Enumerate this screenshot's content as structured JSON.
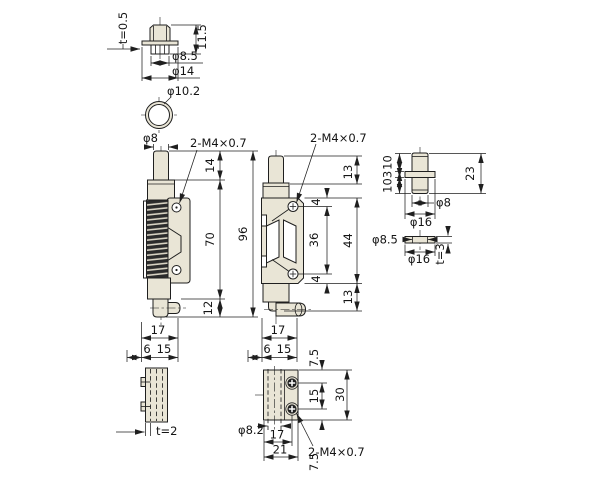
{
  "drawing_type": "engineering-dimension-drawing",
  "part": "spring-loaded latch bolt with mounting plate, pin, washer and cap",
  "colors": {
    "bg": "#ffffff",
    "line": "#1f1f1f",
    "metal": "#e9e5d6",
    "spring": "#2b2b2b",
    "spring_gap": "#d8d3c3"
  },
  "views": {
    "cap": {
      "thickness": "t=0.5",
      "height": "11.5",
      "inner_dia": "φ8.5",
      "flange_dia": "φ14"
    },
    "top": {
      "outer_dia": "φ10.2"
    },
    "front": {
      "pin_dia": "φ8",
      "thread": "2-M4×0.7",
      "pin_len": "14",
      "body_len": "70",
      "total_len": "96",
      "tail_len": "12",
      "width": "17",
      "offset": "6",
      "plate_w": "15"
    },
    "side": {
      "thread": "2-M4×0.7",
      "top_gap": "13",
      "hole_edge_top": "4",
      "hole_pitch": "36",
      "plate_len": "44",
      "hole_edge_bottom": "4",
      "bottom_gap": "13",
      "width": "17",
      "offset": "6",
      "plate_w": "15"
    },
    "pin": {
      "top_len": "10",
      "flange_t": "3",
      "bottom_len": "10",
      "total_len": "23",
      "dia": "φ8",
      "flange_dia": "φ16"
    },
    "washer": {
      "hole_dia": "φ8.5",
      "outer_dia": "φ16",
      "thickness": "t=3"
    },
    "plate_edge": {
      "thickness": "t=2"
    },
    "plate_face": {
      "top_margin": "7.5",
      "hole_pitch": "15",
      "height": "30",
      "bottom_margin": "7.5",
      "hole_dia": "φ8.2",
      "hole_offset": "17",
      "width": "21",
      "thread": "2-M4×0.7"
    }
  }
}
